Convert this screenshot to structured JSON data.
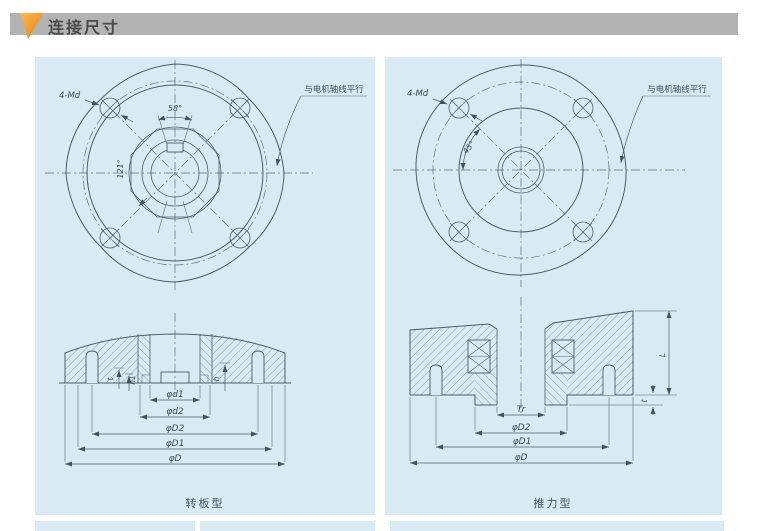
{
  "header": {
    "title": "连接尺寸"
  },
  "colors": {
    "panel_bg": "#d8ebf4",
    "header_bg": "#b3b3b3",
    "header_text": "#4a4a4a",
    "accent_orange": "#ee7d0c",
    "line": "#4d5d68"
  },
  "panels": {
    "left": {
      "top_view": {
        "holes_label": "4-Md",
        "angle_top": "58°",
        "angle_side": "121°",
        "note": "与电机轴线平行"
      },
      "section": {
        "dims": [
          "φd1",
          "φd2",
          "φD2",
          "φD1",
          "φD"
        ],
        "dim_t": "t",
        "dim_h1": "h1",
        "dim_h": "h"
      },
      "caption": "转板型"
    },
    "right": {
      "top_view": {
        "holes_label": "4-Md",
        "angle": "45°",
        "note": "与电机轴线平行"
      },
      "section": {
        "dims": [
          "Tr",
          "φD2",
          "φD1",
          "φD"
        ],
        "dim_L": "L",
        "dim_t": "t"
      },
      "caption": "推力型"
    }
  }
}
